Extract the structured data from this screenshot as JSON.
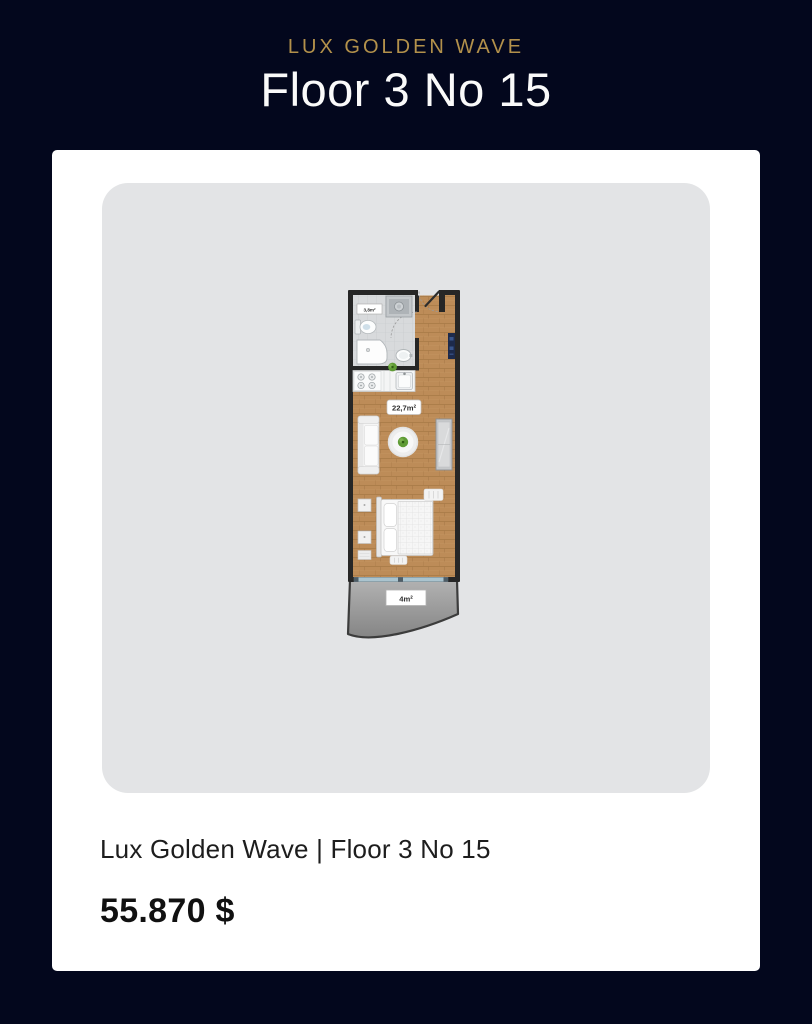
{
  "header": {
    "brand": "LUX GOLDEN WAVE",
    "title": "Floor 3 No 15"
  },
  "card": {
    "caption": "Lux Golden Wave | Floor 3 No 15",
    "price": "55.870 $"
  },
  "floor_plan": {
    "living_area_label": "22,7m²",
    "bathroom_area_label": "3,8m²",
    "balcony_area_label": "4m²"
  },
  "colors": {
    "background": "#03071d",
    "accent_gold": "#b3914b",
    "card_background": "#ffffff",
    "panel_background": "#e3e4e6",
    "wall": "#262626",
    "wood_floor": "#bd8c58",
    "bathroom_tile": "#d8dadc",
    "balcony_floor": "#9a9a9a",
    "entry_marker_navy": "#1d2a4b",
    "plant_green": "#5f9b35",
    "glass_door": "#aac4cf"
  }
}
